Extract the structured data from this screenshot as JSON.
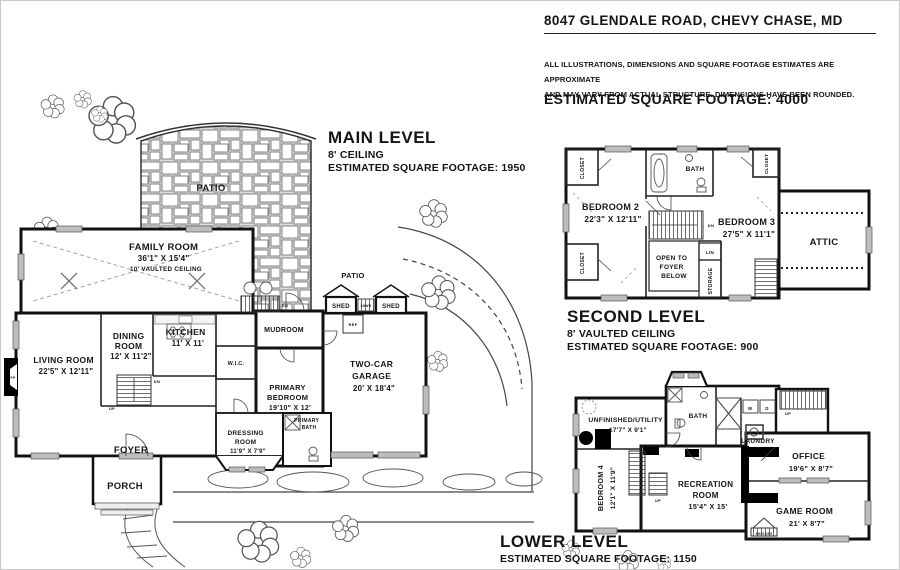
{
  "header": {
    "address": "8047 GLENDALE ROAD, CHEVY CHASE, MD",
    "disclaimer_line1": "ALL ILLUSTRATIONS, DIMENSIONS AND SQUARE FOOTAGE ESTIMATES ARE APPROXIMATE",
    "disclaimer_line2": "AND MAY VARY FROM ACTUAL STRUCTURE. DIMENSIONS HAVE BEEN ROUNDED.",
    "total_sqft": "ESTIMATED SQUARE FOOTAGE: 4000"
  },
  "levels": {
    "main": {
      "title": "MAIN LEVEL",
      "ceiling": "8' CEILING",
      "sqft": "ESTIMATED SQUARE FOOTAGE: 1950"
    },
    "second": {
      "title": "SECOND LEVEL",
      "ceiling": "8' VAULTED CEILING",
      "sqft": "ESTIMATED SQUARE FOOTAGE: 900"
    },
    "lower": {
      "title": "LOWER LEVEL",
      "sqft": "ESTIMATED SQUARE FOOTAGE: 1150"
    }
  },
  "main_level": {
    "patio_upper": "PATIO",
    "patio_lower": "PATIO",
    "family_name": "FAMILY ROOM",
    "family_dims": "36'1\" X 15'4\"",
    "family_note": "10' VAULTED CEILING",
    "living_name": "LIVING ROOM",
    "living_dims": "22'5\" X 12'11\"",
    "dining_l1": "DINING",
    "dining_l2": "ROOM",
    "dining_dims": "12' X 11'2\"",
    "kitchen_name": "KITCHEN",
    "kitchen_dims": "11' X 11'",
    "mudroom": "MUDROOM",
    "wic": "W.I.C.",
    "garage_l1": "TWO-CAR",
    "garage_l2": "GARAGE",
    "garage_dims": "20' X 18'4\"",
    "primary_l1": "PRIMARY",
    "primary_l2": "BEDROOM",
    "primary_dims": "19'10\" X 12'",
    "pbath_l1": "PRIMARY",
    "pbath_l2": "BATH",
    "dressing_l1": "DRESSING",
    "dressing_l2": "ROOM",
    "dressing_dims": "11'9\" X 7'9\"",
    "foyer": "FOYER",
    "porch": "PORCH",
    "shed1": "SHED",
    "shed2": "SHED",
    "shwr": "SHWR",
    "ref": "REF",
    "fp": "FP",
    "up": "UP",
    "dn": "DN"
  },
  "second_level": {
    "bedroom2_name": "BEDROOM 2",
    "bedroom2_dims": "22'3\" X 12'11\"",
    "bedroom3_name": "BEDROOM 3",
    "bedroom3_dims": "27'5\" X 11'1\"",
    "bath": "BATH",
    "attic": "ATTIC",
    "lin": "LIN",
    "open_l1": "OPEN TO",
    "open_l2": "FOYER",
    "open_l3": "BELOW",
    "storage": "STORAGE",
    "closet_tl": "CLOSET",
    "closet_bl": "CLOSET",
    "closet_tr": "CLOSET",
    "dn": "DN"
  },
  "lower_level": {
    "unfinished_name": "UNFINISHED/UTILITY",
    "unfinished_dims": "17'7\" X 9'1\"",
    "bath": "BATH",
    "laundry": "LAUNDRY",
    "washer": "W",
    "dryer": "D",
    "bedroom4_name": "BEDROOM 4",
    "bedroom4_dims": "12'1\" X 11'9\"",
    "rec_l1": "RECREATION",
    "rec_l2": "ROOM",
    "rec_dims": "15'4\" X 15'",
    "office_name": "OFFICE",
    "office_dims": "19'6\" X 8'7\"",
    "game_name": "GAME ROOM",
    "game_dims": "21' X 8'7\"",
    "shelves": "SHELVES",
    "up": "UP"
  }
}
